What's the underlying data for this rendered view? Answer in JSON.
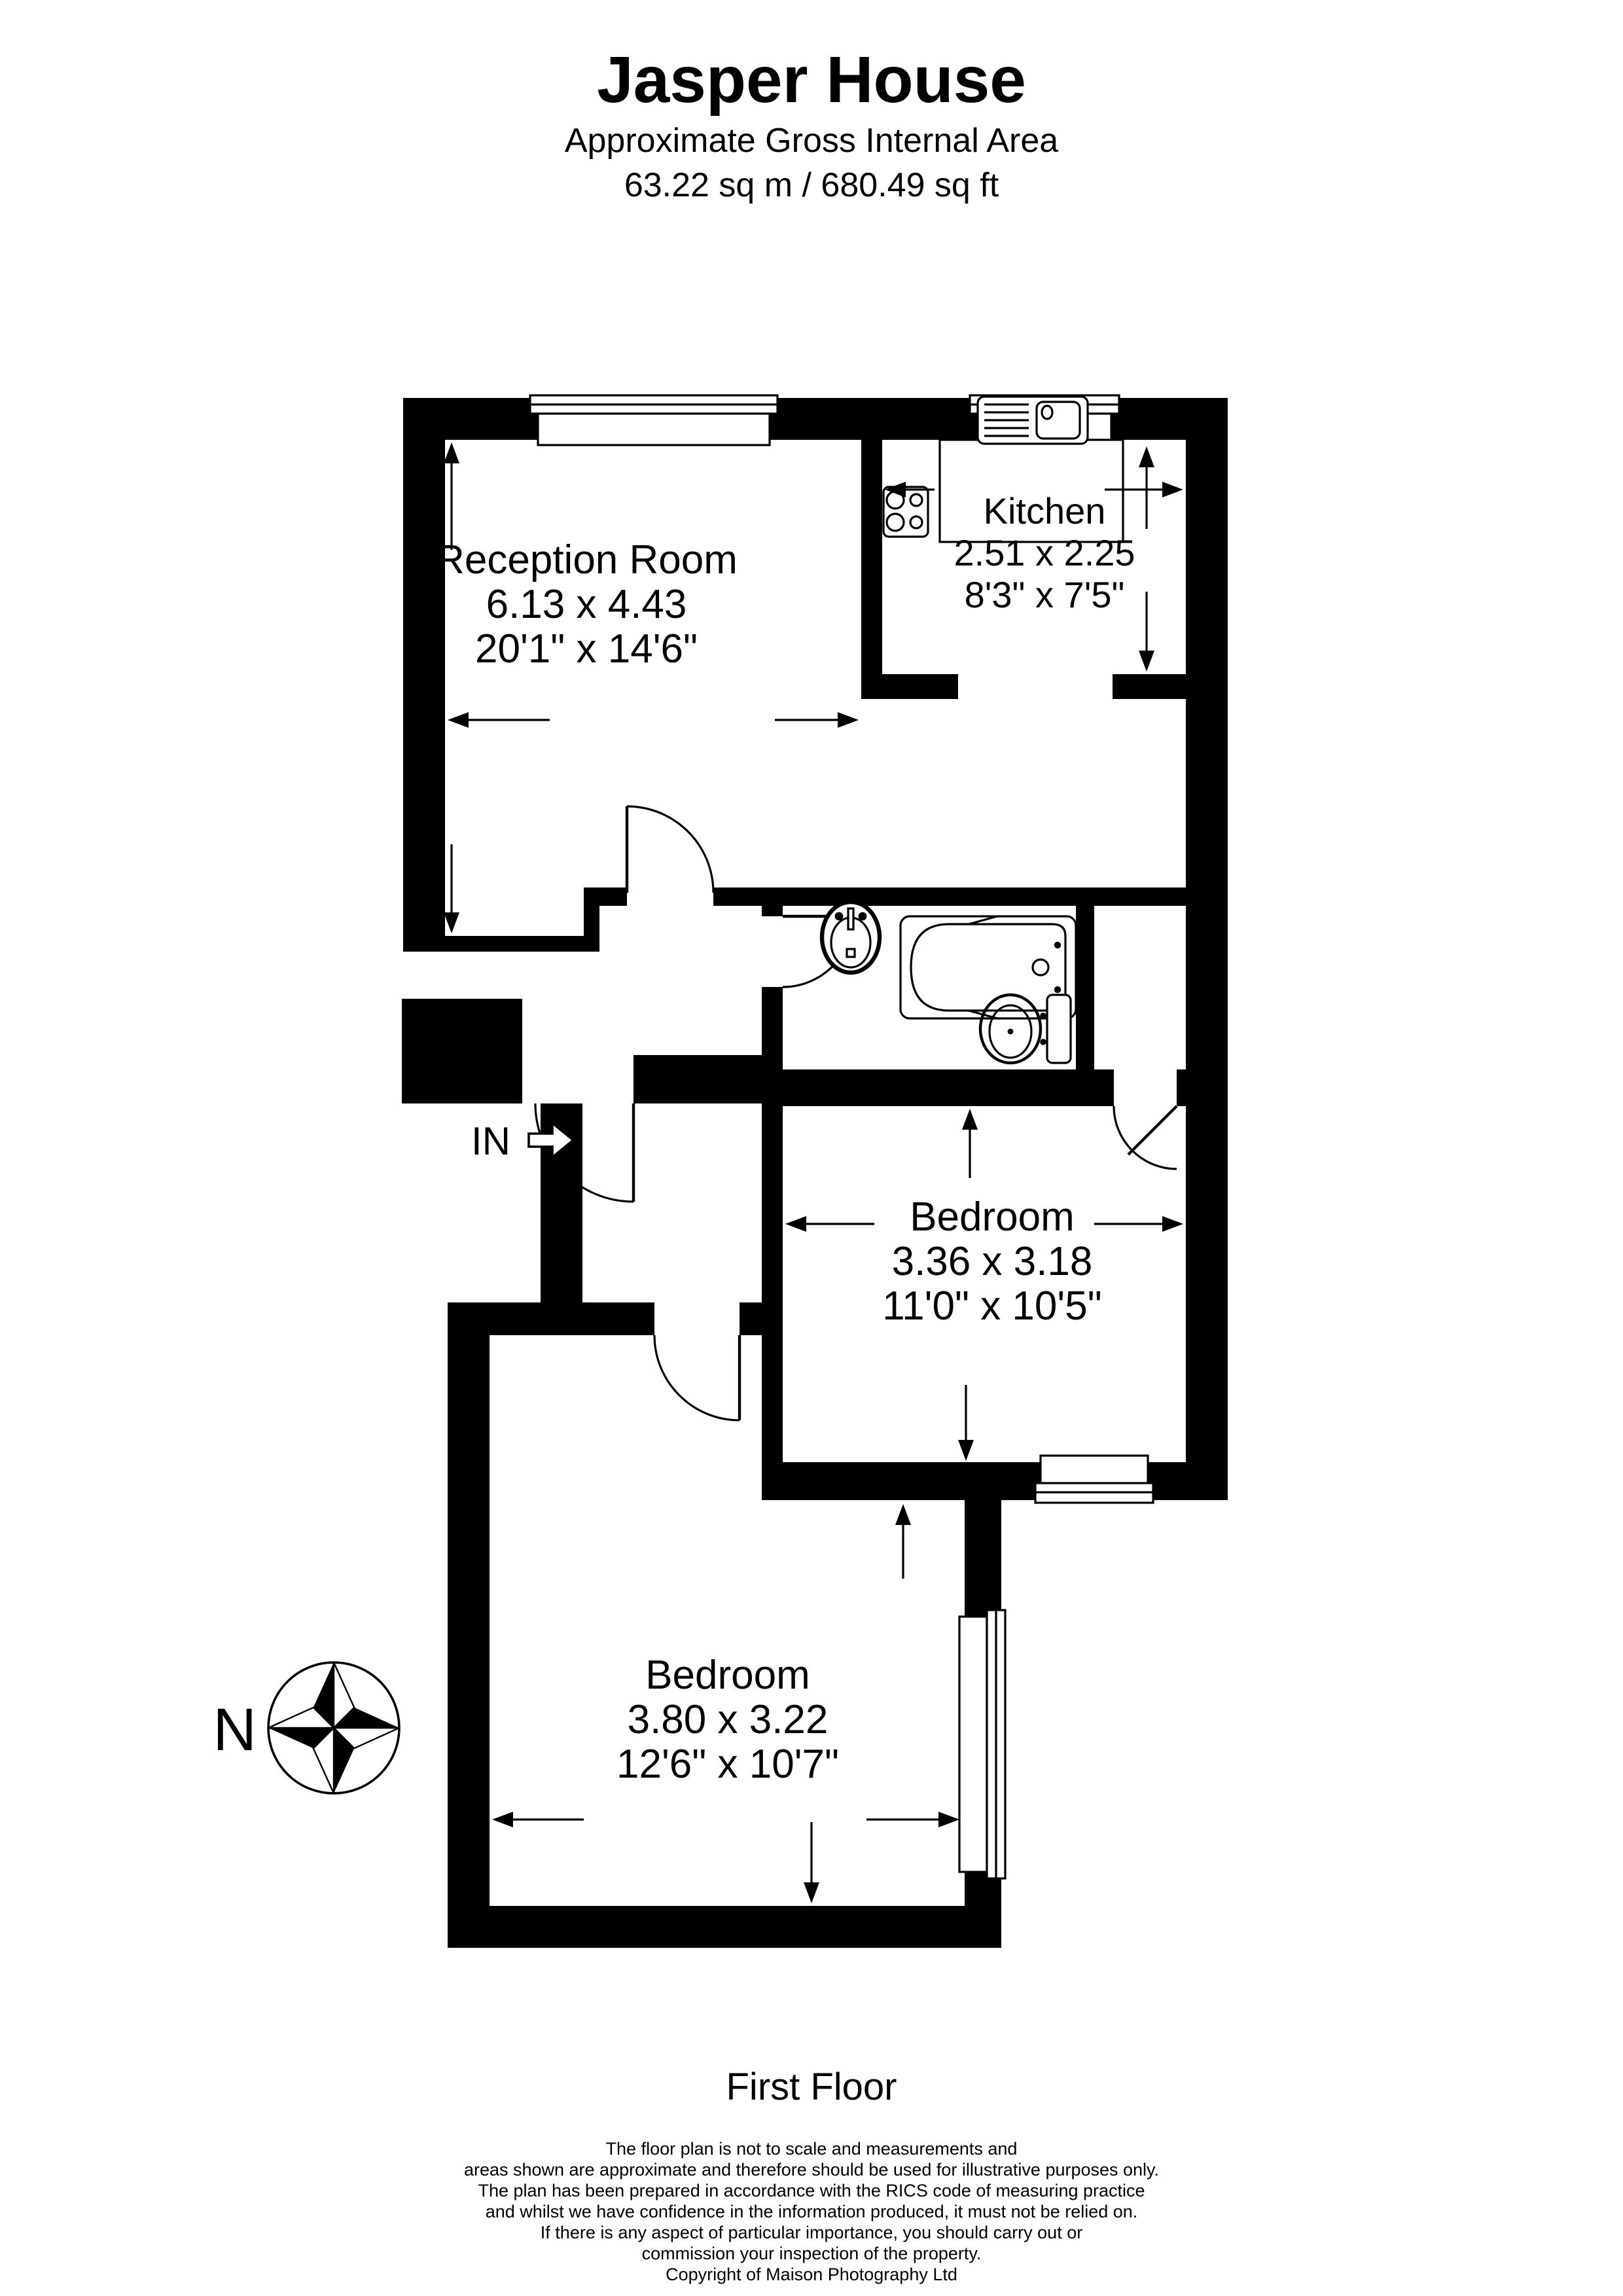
{
  "title": "Jasper House",
  "subtitle": "Approximate Gross Internal Area",
  "area": "63.22 sq m / 680.49 sq ft",
  "floor_label": "First Floor",
  "entrance_label": "IN",
  "compass_label": "N",
  "rooms": {
    "reception": {
      "name": "Reception Room",
      "metric": "6.13 x 4.43",
      "imperial": "20'1\" x 14'6\""
    },
    "kitchen": {
      "name": "Kitchen",
      "metric": "2.51 x 2.25",
      "imperial": "8'3\" x 7'5\""
    },
    "bedroom1": {
      "name": "Bedroom",
      "metric": "3.36 x 3.18",
      "imperial": "11'0\" x 10'5\""
    },
    "bedroom2": {
      "name": "Bedroom",
      "metric": "3.80 x 3.22",
      "imperial": "12'6\" x 10'7\""
    }
  },
  "disclaimer": [
    "The floor plan is not to scale and measurements and",
    "areas shown are approximate and therefore should be used for illustrative purposes only.",
    "The plan has been prepared in accordance with the RICS code of measuring practice",
    "and whilst we have confidence in the information produced, it must not be relied on.",
    "If there is any aspect of particular importance, you should carry out or",
    "commission your inspection of the property.",
    "Copyright of Maison Photography Ltd"
  ],
  "colors": {
    "wall": "#000000",
    "background": "#ffffff"
  }
}
